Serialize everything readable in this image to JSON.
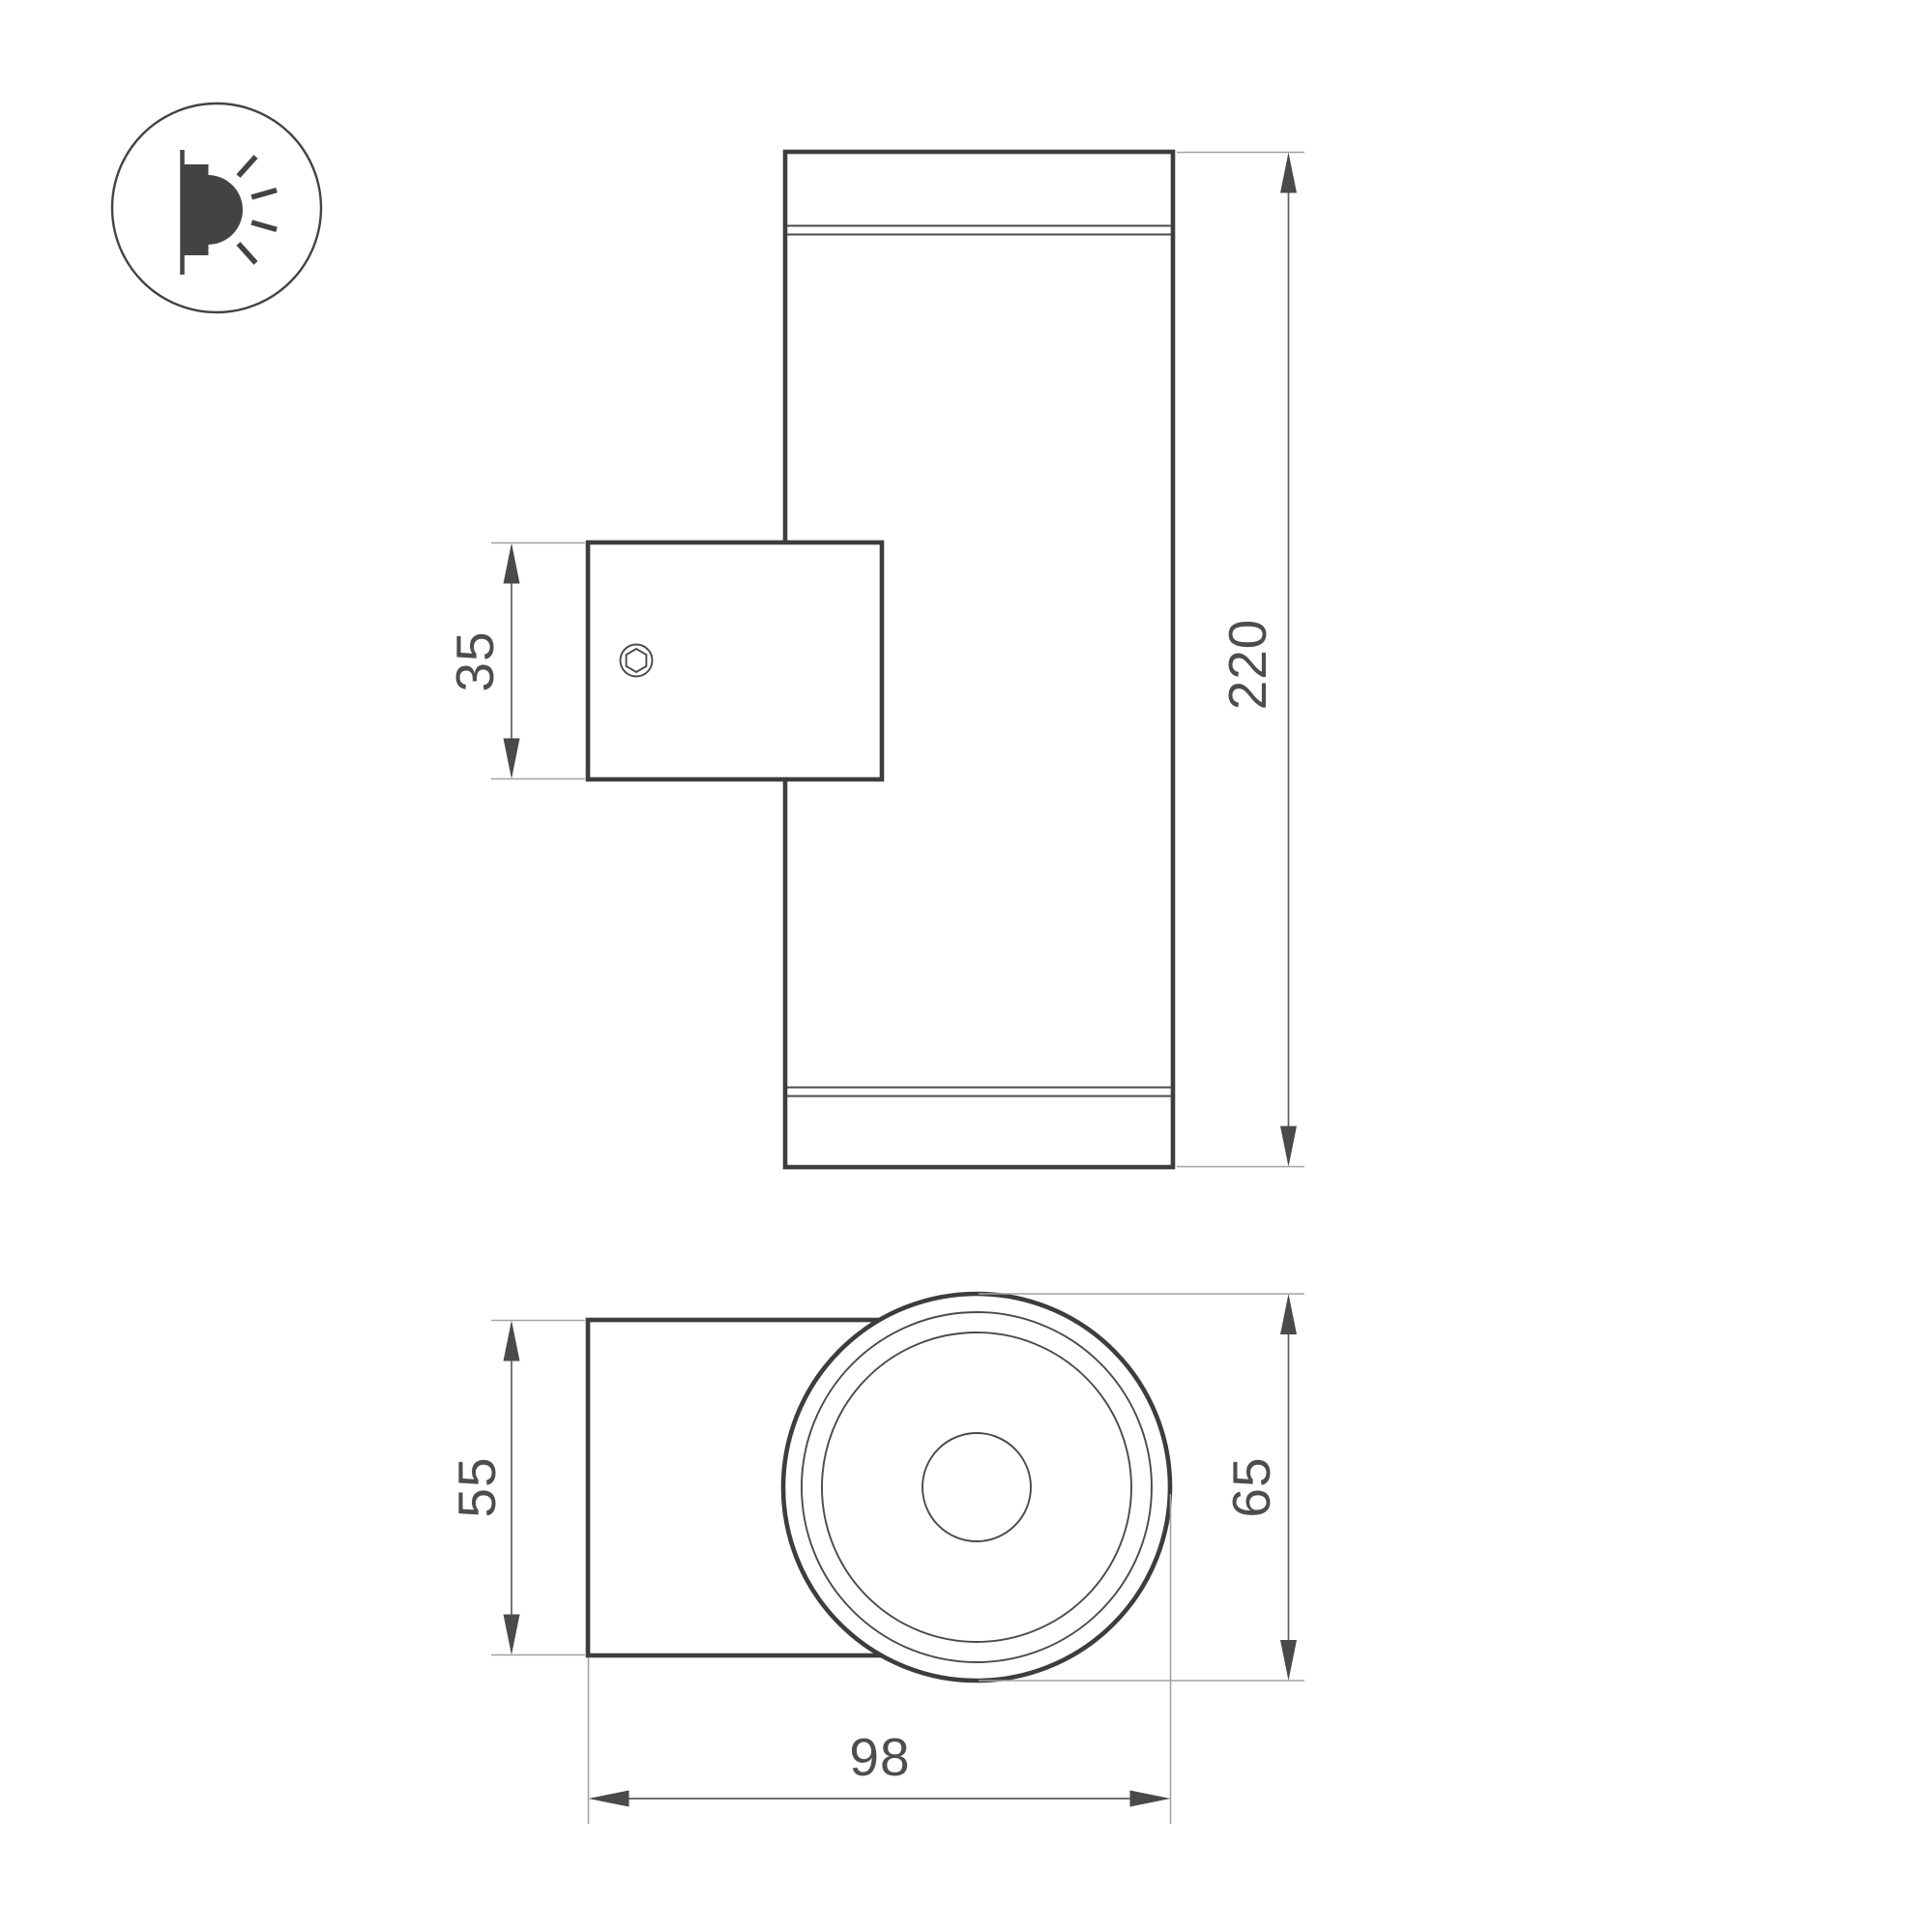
{
  "icon": {
    "name": "wall-light-side-emission-icon"
  },
  "dimensions": {
    "bracket_height": "35",
    "total_height": "220",
    "bracket_depth": "55",
    "body_diameter": "65",
    "total_depth": "98"
  },
  "colors": {
    "outline": "#3d3d3d",
    "thin_line": "#4a4a4a",
    "dimension_line": "#5f5f5f",
    "extension_line": "#a2a2a2",
    "arrow": "#4a4a4a",
    "text": "#4d4d4d",
    "background": "#ffffff"
  }
}
